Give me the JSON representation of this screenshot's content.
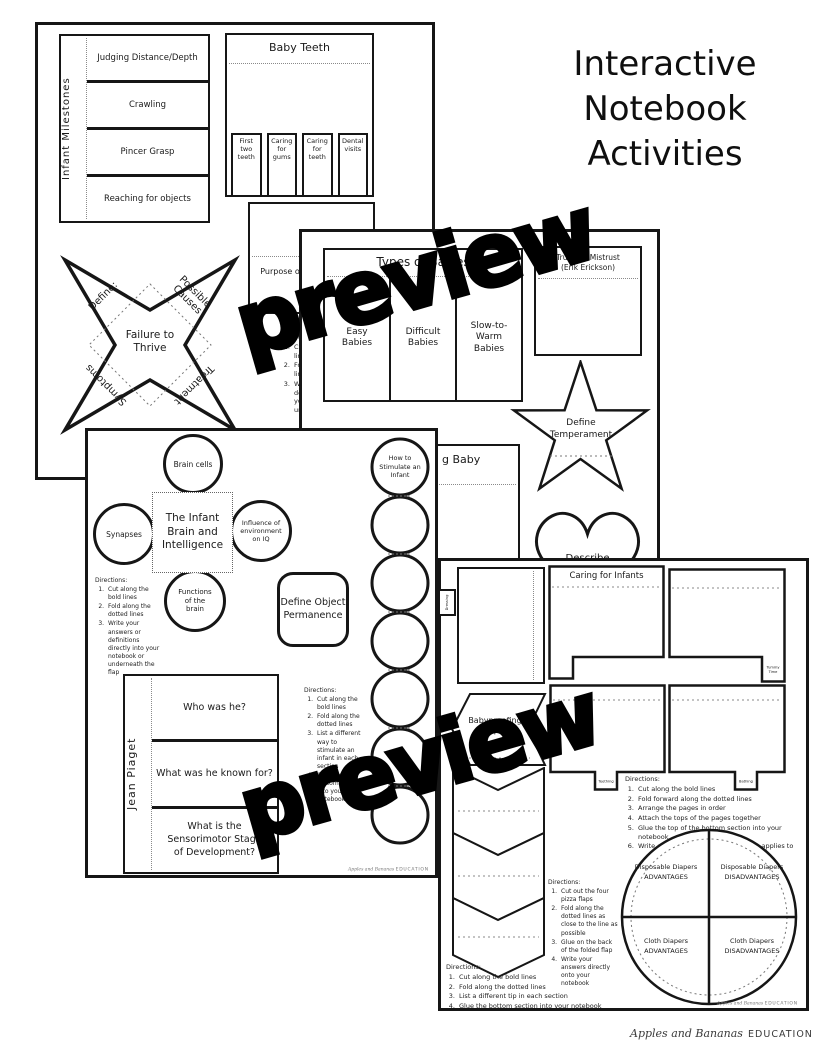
{
  "title": {
    "line1": "Interactive",
    "line2": "Notebook",
    "line3": "Activities"
  },
  "watermark": "preview",
  "brand": {
    "name": "Apples and Bananas",
    "suffix": "EDUCATION"
  },
  "page1": {
    "milestones": {
      "label": "Infant Milestones",
      "rows": [
        "Judging Distance/Depth",
        "Crawling",
        "Pincer Grasp",
        "Reaching for objects"
      ]
    },
    "baby_teeth": {
      "title": "Baby Teeth",
      "tabs": [
        "First two teeth",
        "Caring for gums",
        "Caring for teeth",
        "Dental visits"
      ]
    },
    "growth_charts": "Purpose of Growth Charts",
    "directions": {
      "heading": "Directions:",
      "items": [
        "Cut along the bold lines",
        "Fold along the dotted lines",
        "Write your answers or definitions directly into your notebook or underneath the flaps"
      ]
    },
    "cootie_catcher": {
      "center": "Failure to Thrive",
      "top_left": "Define:",
      "top_right": "Possible Causes",
      "bottom_left": "Symptoms",
      "bottom_right": "Treatment"
    }
  },
  "page2": {
    "types_of_babies": {
      "title": "Types of Babies",
      "columns": [
        "Easy Babies",
        "Difficult Babies",
        "Slow-to-Warm Babies"
      ]
    },
    "trust_box": {
      "title": "Trust vs. Mistrust",
      "subtitle": "(Erik Erickson)"
    },
    "temperament_star": "Define Temperament",
    "baby_flap": "g Baby",
    "heart": {
      "line1": "Describe",
      "line2": "“Goodness of"
    }
  },
  "page3": {
    "brain_foldable": {
      "center": "The Infant Brain and Intelligence",
      "top": "Brain cells",
      "left": "Synapses",
      "right": "Influence of environment on IQ",
      "bottom": "Functions of the brain"
    },
    "directions_brain": {
      "heading": "Directions:",
      "items": [
        "Cut along the bold lines",
        "Fold along the dotted lines",
        "Write your answers or definitions directly into your notebook or underneath the flap"
      ]
    },
    "object_permanence": "Define Object Permanence",
    "stimulate_chain": "How to Stimulate an Infant",
    "directions_chain": {
      "heading": "Directions:",
      "items": [
        "Cut along the bold lines",
        "Fold along the dotted lines",
        "List a different way to stimulate an infant in each section",
        "Glue the bottom section into your notebook"
      ]
    },
    "piaget": {
      "label": "Jean Piaget",
      "rows": [
        "Who was he?",
        "What was he known for?",
        "What is the Sensorimotor Stage of Development?"
      ]
    }
  },
  "page4": {
    "caring": {
      "title": "Caring for Infants",
      "tab_dressing": "Dressing",
      "tab_tummy": "Tummy Time",
      "tab_teething": "Teething",
      "tab_bathing": "Bathing"
    },
    "babyproofing": "Babyproofing Tips",
    "directions_pages": {
      "heading": "Directions:",
      "items": [
        "Cut along the bold lines",
        "Fold forward along the dotted lines",
        "Arrange the pages in order",
        "Attach the tops of the pages together",
        "Glue the top of the bottom section into your notebook",
        "Write about each topic on the page it applies to"
      ]
    },
    "directions_pizza": {
      "heading": "Directions:",
      "items": [
        "Cut out the four pizza flaps",
        "Fold along the dotted lines as close to the line as possible",
        "Glue on the back of the folded flap",
        "Write your answers directly onto your notebook"
      ]
    },
    "directions_zigzag": {
      "heading": "Directions:",
      "items": [
        "Cut along the bold lines",
        "Fold along the dotted lines",
        "List a different tip in each section",
        "Glue the bottom section into your notebook"
      ]
    },
    "diaper_wheel": {
      "tl1": "Disposable Diapers",
      "tl2": "ADVANTAGES",
      "tr1": "Disposable Diapers",
      "tr2": "DISADVANTAGES",
      "bl1": "Cloth Diapers",
      "bl2": "ADVANTAGES",
      "br1": "Cloth Diapers",
      "br2": "DISADVANTAGES"
    }
  }
}
